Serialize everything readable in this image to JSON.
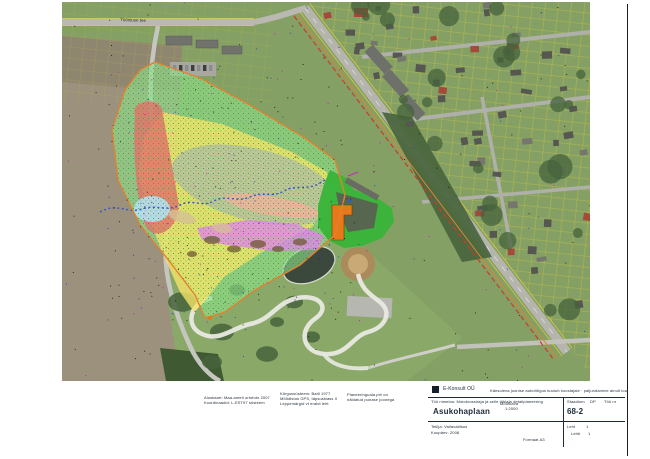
{
  "sheet": {
    "street_label": "Tööstuse tee",
    "notes": {
      "block1_line1": "Aluskaart: Maa-ameti ortofoto 2007",
      "block1_line2": "Koordinaadid: L-EST97 süsteem",
      "block2_line1": "Kõrgussüsteem: Balti 1977",
      "block2_line2": "Mõõdistus GPS, täpsusklass II",
      "block2_line3": "Leppemärgid vt eraldi leht",
      "block3_line1": "Planeeringuala piir on",
      "block3_line2": "näidatud punase joonega"
    },
    "titleblock": {
      "logo_text": "E-Konsult OÜ",
      "copyright_note": "Käesoleva joonise autoriõigus kuulub koostajale · paljundamine ainult loal",
      "project_label": "Töö nimetus: Motokrossiraja ja selle lähiala detailplaneering",
      "drawing_title": "Asukohaplaan",
      "scale_label": "Mõõtkava",
      "scale_value": "1:2000",
      "stage_label": "Staadium",
      "stage_value": "DP",
      "worknr_label": "Töö nr",
      "sheet_number": "68-2",
      "client_line": "Tellija: Vallavalitsus",
      "date_line": "Kuupäev: 2008",
      "format_note": "Formaat A3",
      "sheet_label": "Leht",
      "sheet_value": "1",
      "sheets_label": "Lehti",
      "sheets_value": "1"
    },
    "colors": {
      "base_grass": "#84a065",
      "field_tan": "#9b917c",
      "park_green": "#8aa968",
      "road_gray": "#b9b9b2",
      "road_yellow": "#ddcc3d",
      "cadastral_yellow": "#d8c838",
      "house_dark": "#565750",
      "house_light": "#75766d",
      "house_red": "#a34a38",
      "tree_dark": "#46633c",
      "pond": "#3a493c",
      "track_white": "#e9e9e3",
      "dirt_brown": "#ab8a5c",
      "dirt_light": "#c9a976",
      "parking_gray": "#b7b7b1",
      "zone_outer": "#8fe08a",
      "zone_dots": "#2f9e2f",
      "zone_yellow": "#f3e468",
      "zone_red": "#e0756b",
      "zone_blue_light": "#b4e0f2",
      "zone_gray_blue": "#91a6b6",
      "zone_salmon": "#f2b29c",
      "zone_magenta": "#e184e8",
      "facility_green": "#38b438",
      "building_orange": "#e67a1a",
      "asphalt_dark": "#5a5b52",
      "boundary_orange": "#e08232",
      "boundary_red": "#cf3a27",
      "squiggle_blue": "#3a55c4"
    }
  }
}
